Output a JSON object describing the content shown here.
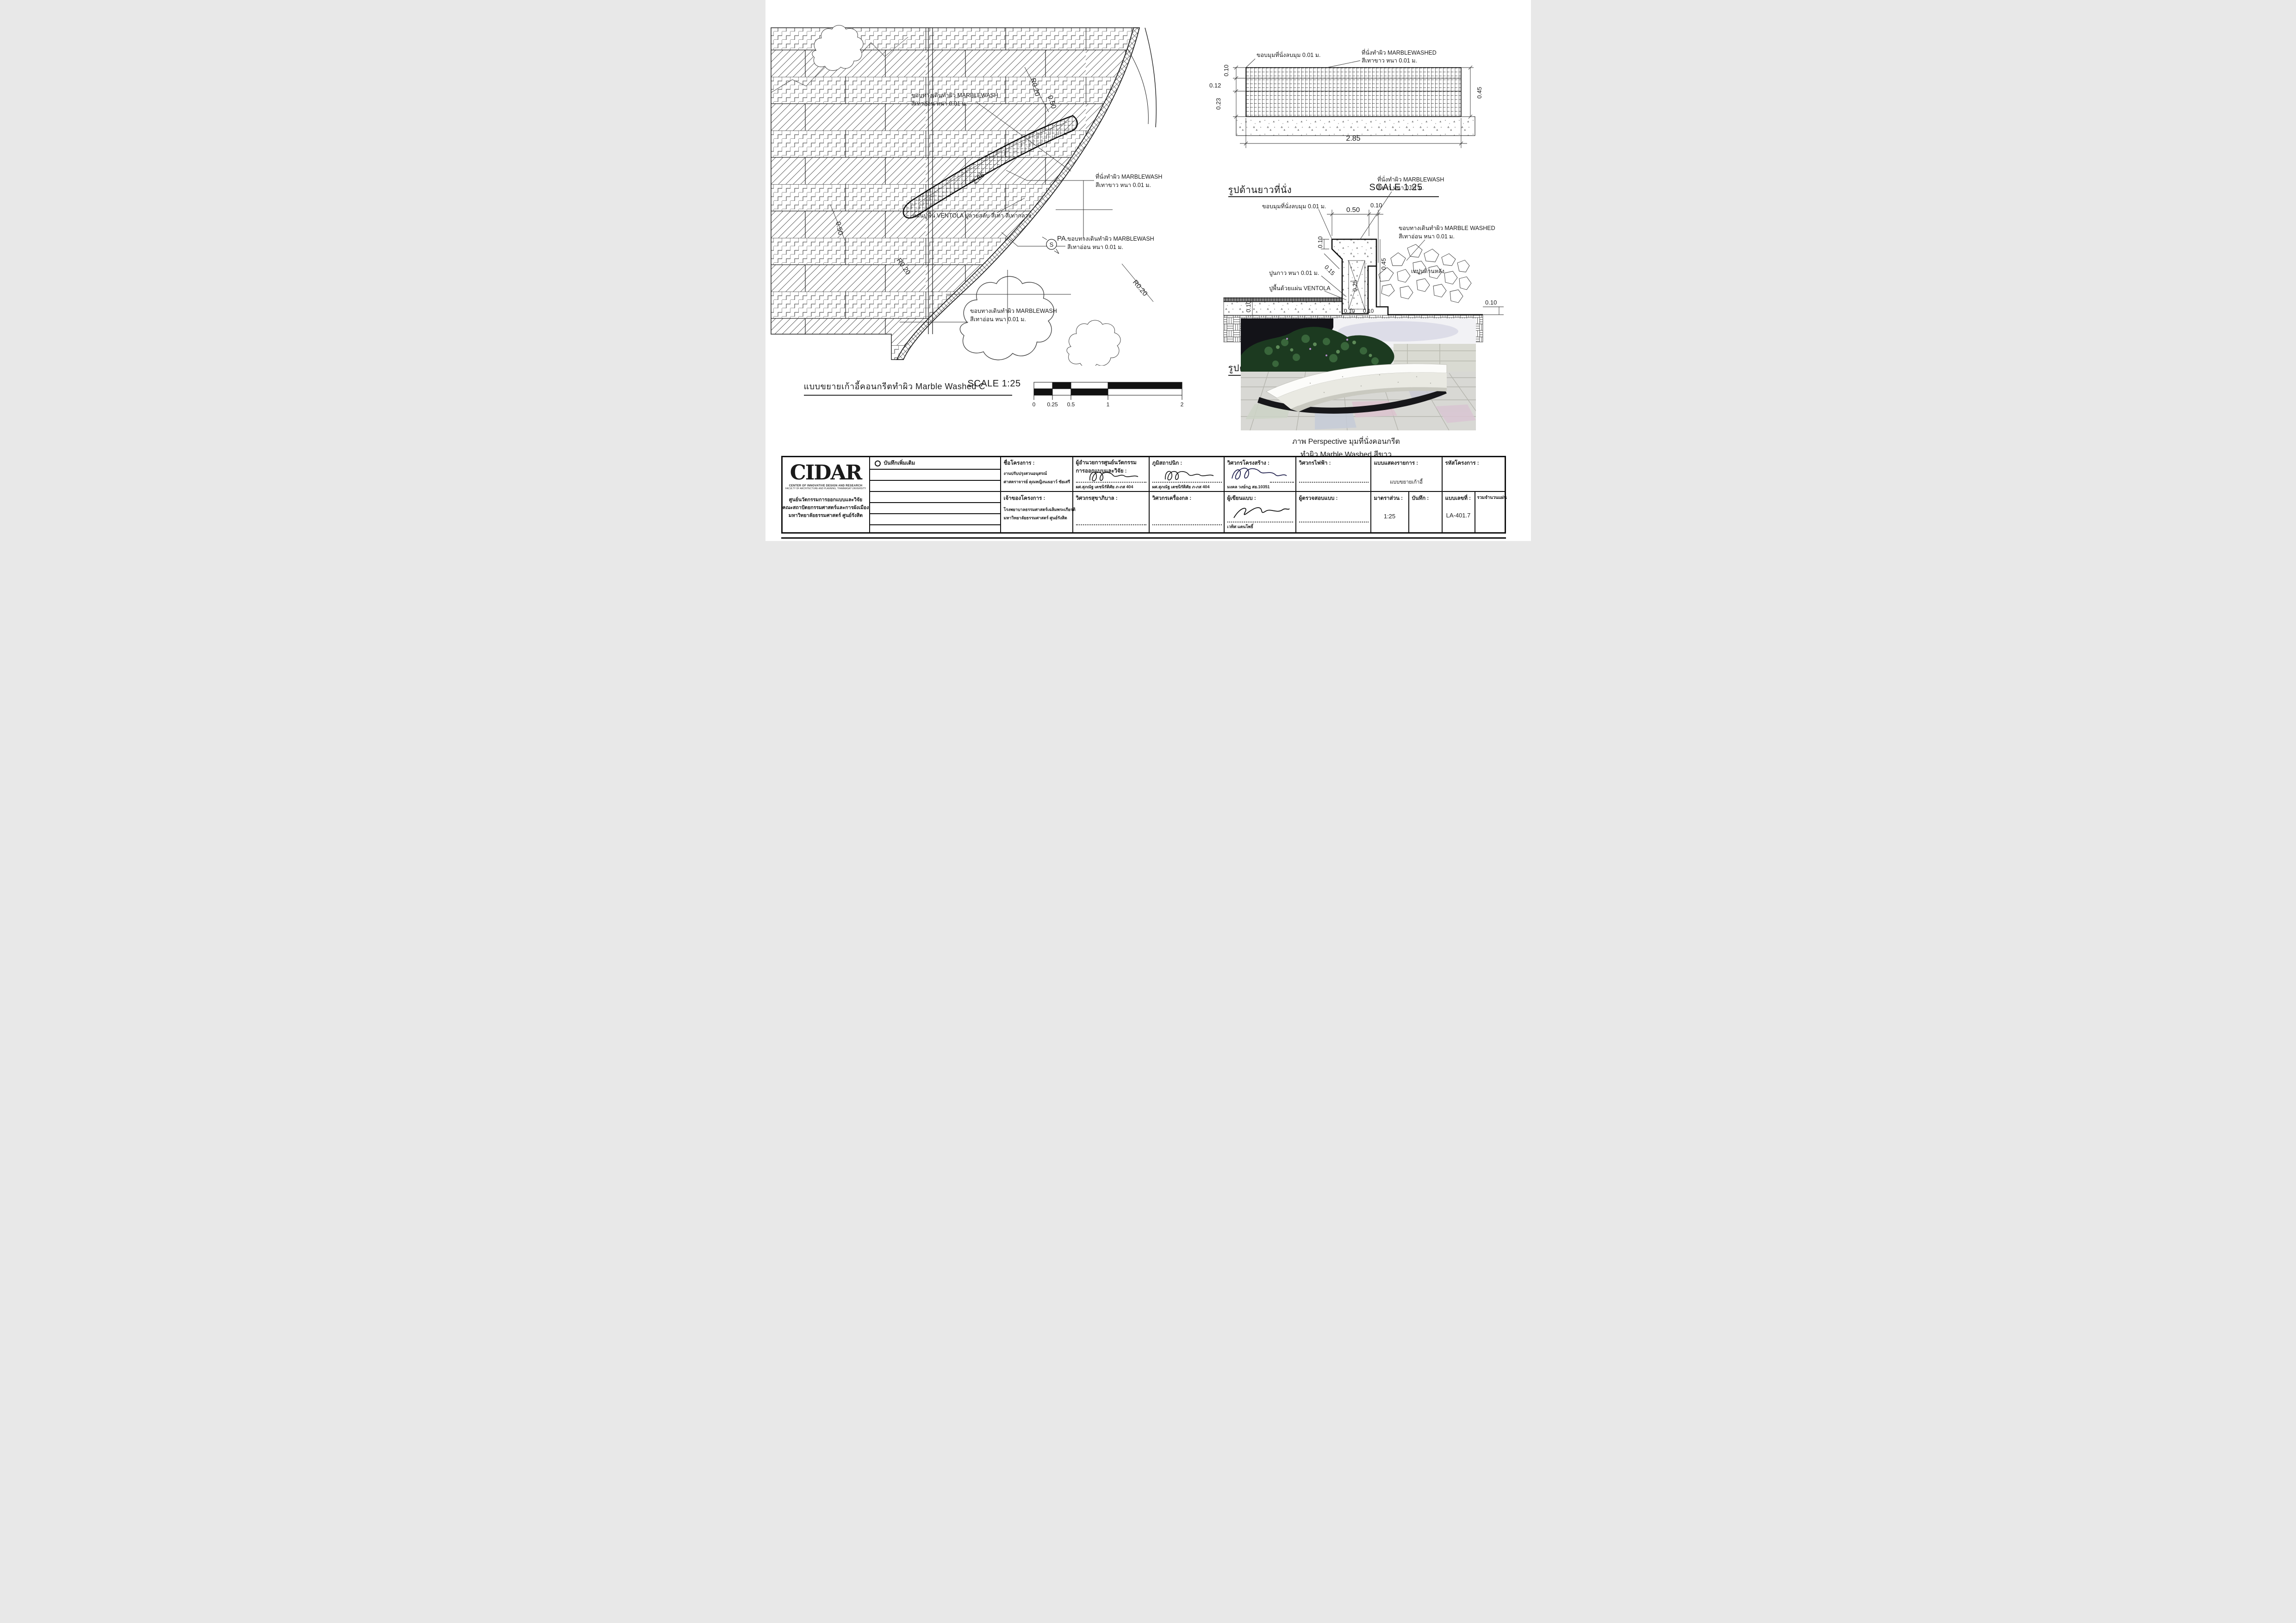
{
  "plan": {
    "labels": {
      "walk_top1": "ขอบทางเดินทำผิว MARBLEWASH",
      "walk_top2": "สีเทาอ่อน หนา 0.01 ม.",
      "ventola": "แผ่นปูพื้น VENTOLA ปูลายสลับ สีเทา สีเทากลาง",
      "seat1": "ที่นั่งทำผิว MARBLEWASH",
      "seat2": "สีเทาขาว หนา 0.01 ม.",
      "curb1": "ขอบทางเดินทำผิว MARBLEWASH",
      "curb2": "สีเทาอ่อน หนา 0.01 ม.",
      "walk_bot1": "ขอบทางเดินทำผิว MARBLEWASH",
      "walk_bot2": "สีเทาอ่อน หนา 0.01 ม.",
      "pa": "PA.",
      "s": "S"
    },
    "dims": [
      "R0.20",
      "0.50",
      "R0.20",
      "2.85",
      "0.50",
      "R0.20"
    ],
    "title": "แบบขยายเก้าอี้คอนกรีตทำผิว Marble Washed C",
    "scale_label": "SCALE 1:25",
    "scalebar": [
      "0",
      "0.25",
      "0.5",
      "1",
      "2"
    ]
  },
  "elevation": {
    "labels": {
      "corner": "ขอบมุมที่นั่งลบมุม 0.01 ม.",
      "seat1": "ที่นั่งทำผิว MARBLEWASHED",
      "seat2": "สีเทาขาว หนา 0.01 ม."
    },
    "dims": {
      "v010": "0.10",
      "v012": "0.12",
      "v023": "0.23",
      "v045": "0.45",
      "v285": "2.85"
    },
    "title": "รูปด้านยาวที่นั่ง",
    "scale_label": "SCALE 1:25"
  },
  "section": {
    "labels": {
      "seat1": "ที่นั่งทำผิว MARBLEWASH",
      "seat2": "สีขาว หนา 0.01 ม.",
      "corner": "ขอบมุมที่นั่งลบมุม 0.01 ม.",
      "curb1": "ขอบทางเดินทำผิว MARBLE WASHED",
      "curb2": "สีเทาอ่อน หนา 0.01 ม.",
      "glue": "ปูนกาว หนา 0.01 ม.",
      "floor": "ปูพื้นด้วยแผ่น VENTOLA",
      "back": "เทปูนด้านหลัง"
    },
    "dims": {
      "top050": "0.50",
      "top010": "0.10",
      "s010": "0.10",
      "s015": "0.15",
      "s025": "0.25",
      "s045": "0.45",
      "l010": "0.10",
      "b010a": "0.10",
      "b010b": "0.10",
      "r010": "0.10"
    },
    "title": "รูปตัดที่นั่ง",
    "scale_label": "SCALE 1:25"
  },
  "perspective": {
    "caption1": "ภาพ Perspective มุมที่นั่งคอนกรีต",
    "caption2": "ทำผิว Marble Washed สีขาว"
  },
  "titleblock": {
    "logo": {
      "name": "CIDAR",
      "sub1": "CENTER OF INNOVATIVE DESIGN AND RESEARCH",
      "sub2": "FACULTY OF ARCHITECTURE AND PLANNING, THAMMASAT UNIVERSITY",
      "th1": "ศูนย์นวัตกรรมการออกแบบและวิจัย",
      "th2": "คณะสถาปัตยกรรมศาสตร์และการผังเมือง",
      "th3": "มหาวิทยาลัยธรรมศาสตร์ ศูนย์รังสิต"
    },
    "notes_label": "บันทึกเพิ่มเติม",
    "project": {
      "label": "ชื่อโครงการ :",
      "line1": "งานปรับปรุงสวนอนุสรณ์",
      "line2": "ศาสตราจารย์ คุณหญิงนงเยาว์ ชัยเสรี"
    },
    "owner": {
      "label": "เจ้าของโครงการ :",
      "line1": "โรงพยาบาลธรรมศาสตร์เฉลิมพระเกียรติ",
      "line2": "มหาวิทยาลัยธรรมศาสตร์ ศูนย์รังสิต"
    },
    "director": {
      "label1": "ผู้อำนวยการศูนย์นวัตกรรม",
      "label2": "การออกแบบและวิจัย :",
      "name": "ผศ.สุภณัฐ เตชนิรัติศัย ภ-ภส 404"
    },
    "landscape": {
      "label": "ภูมิสถาปนิก :",
      "name": "ผศ.สุภณัฐ เตชนิรัติศัย ภ-ภส 404"
    },
    "structural": {
      "label": "วิศวกรโครงสร้าง :",
      "name": "มงคล วงษ์กฎ สย.10351"
    },
    "electrical": {
      "label": "วิศวกรไฟฟ้า :"
    },
    "sanitary": {
      "label": "วิศวกรสุขาภิบาล :"
    },
    "mechanical": {
      "label": "วิศวกรเครื่องกล :"
    },
    "draftsman": {
      "label": "ผู้เขียนแบบ :",
      "name": "เวทิศ แตนโพธิ์"
    },
    "checker": {
      "label": "ผู้ตรวจสอบแบบ :"
    },
    "drawing_list": {
      "label": "แบบแสดงรายการ :",
      "value": "แบบขยายเก้าอี้"
    },
    "scale": {
      "label": "มาตราส่วน :",
      "value": "1:25"
    },
    "note": {
      "label": "บันทึก :"
    },
    "project_code": {
      "label": "รหัสโครงการ :"
    },
    "sheet_no": {
      "label": "แบบเลขที่ :",
      "value": "LA-401.7"
    },
    "total_sheets": {
      "label": "รวมจำนวนแผ่น"
    }
  }
}
